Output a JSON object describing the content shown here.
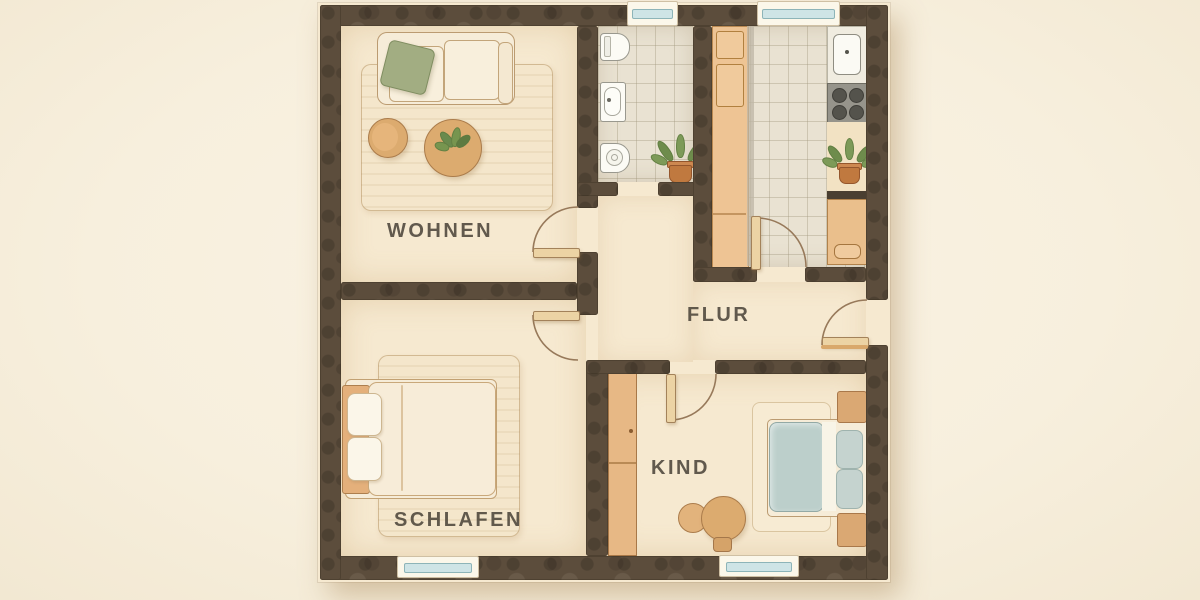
{
  "rooms": [
    {
      "id": "wohnen",
      "label": "WOHNEN"
    },
    {
      "id": "schlafen",
      "label": "SCHLAFEN"
    },
    {
      "id": "flur",
      "label": "FLUR"
    },
    {
      "id": "kind",
      "label": "KIND"
    }
  ],
  "palette": {
    "background": "#f8f0df",
    "wall": "#5c4d3c",
    "floor": "#f6e9d0",
    "tile": "#e9e2d2",
    "wood_counter": "#eec494",
    "door_leaf": "#ecd3a4",
    "window_glass": "#cee4e6",
    "duvet_blue": "#bccfcb",
    "pillow_green": "#a2ad82",
    "plant_green": "#7d9a58",
    "pot_terracotta": "#c0793f",
    "label_text": "#4d463b"
  },
  "furniture": {
    "wohnen": [
      "sofa",
      "green-pillow",
      "coffee-table-small",
      "coffee-table-large",
      "table-plant",
      "rug"
    ],
    "bathroom": [
      "toilet",
      "washbasin",
      "bidet",
      "potted-plant"
    ],
    "kitchen": [
      "tall-cabinets",
      "counter-run",
      "kitchen-sink",
      "stove-4-burners",
      "potted-plant",
      "base-cabinet"
    ],
    "schlafen": [
      "double-bed",
      "headboard",
      "two-pillows",
      "rug"
    ],
    "kind": [
      "wardrobe",
      "bed-blue-duvet",
      "two-pillows",
      "nightstand-top",
      "nightstand-bottom",
      "play-table",
      "stool",
      "rug"
    ]
  },
  "openings": {
    "doors": 6,
    "door_swings_drawn": 5,
    "windows_top": 2,
    "windows_bottom": 2,
    "entrance_side": "right"
  }
}
